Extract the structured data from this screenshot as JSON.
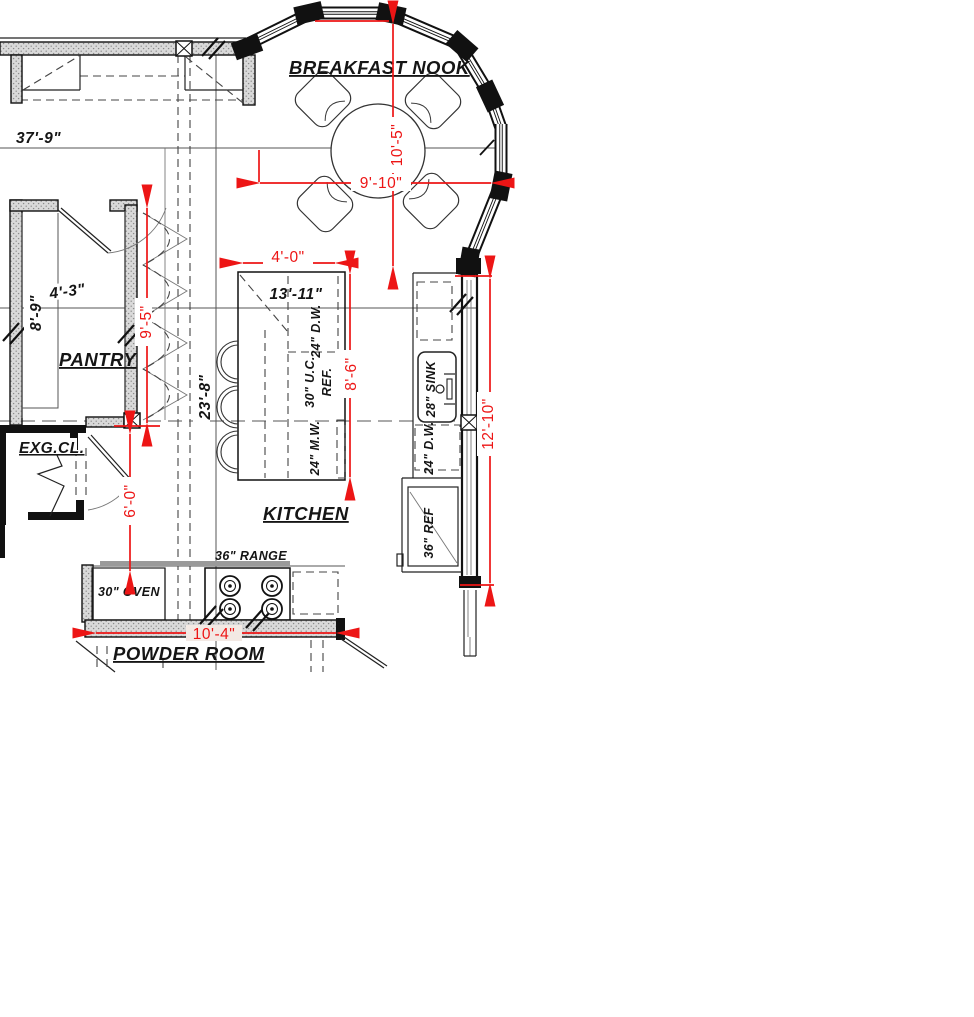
{
  "rooms": {
    "breakfast_nook": "BREAKFAST NOOK",
    "pantry": "PANTRY",
    "exg_closet": "EXG.CL.",
    "kitchen": "KITCHEN",
    "powder_room": "POWDER ROOM"
  },
  "dims": {
    "red": {
      "nook_depth": "10'-5\"",
      "nook_width": "9'-10\"",
      "island_clearance": "4'-0\"",
      "island_length": "8'-6\"",
      "pantry_run": "9'-5\"",
      "aisle": "6'-0\"",
      "sink_wall": "12'-10\"",
      "range_wall": "10'-4\""
    },
    "black": {
      "overall": "37'-9\"",
      "pantry_width": "4'-3\"",
      "pantry_depth": "8'-9\"",
      "kitchen_run": "23'-8\"",
      "island": "13'-11\""
    }
  },
  "appliances": {
    "island_dw": "24\" D.W.",
    "island_ucref_1": "30\" U.C.",
    "island_ucref_2": "REF.",
    "island_mw": "24\" M.W.",
    "sink": "28\" SINK",
    "wall_dw": "24\" D.W.",
    "ref": "36\" REF",
    "range": "36\" RANGE",
    "oven": "30\" OVEN"
  },
  "colors": {
    "dimension_red": "#ed1515",
    "wall_black": "#111111",
    "hatch_gray": "#d9d9d9"
  }
}
